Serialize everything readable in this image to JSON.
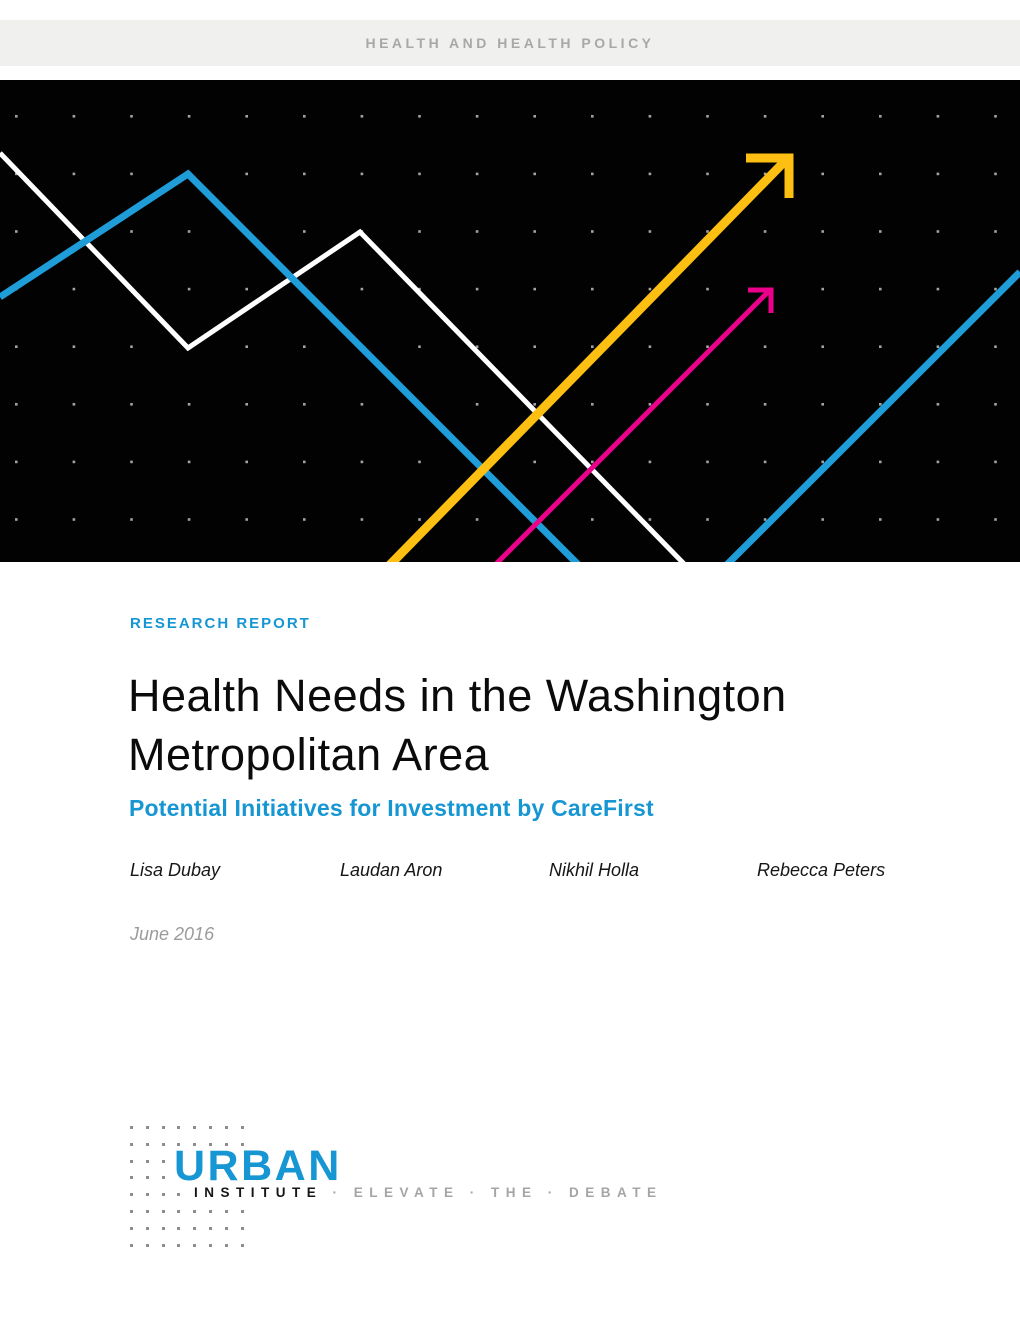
{
  "band": {
    "label": "HEALTH AND HEALTH POLICY"
  },
  "report": {
    "eyebrow": "RESEARCH REPORT",
    "title_line1": "Health Needs in the Washington",
    "title_line2": "Metropolitan Area",
    "subtitle": "Potential Initiatives for Investment by CareFirst",
    "authors": [
      "Lisa Dubay",
      "Laudan Aron",
      "Nikhil Holla",
      "Rebecca Peters"
    ],
    "date": "June 2016"
  },
  "logo": {
    "name": "URBAN",
    "institute": "INSTITUTE",
    "tagline": "· ELEVATE · THE · DEBATE"
  },
  "colors": {
    "accent": "#1696d2",
    "hero_blue": "#1f9dd9",
    "yellow": "#fdbf11",
    "magenta": "#ec008b",
    "line_white": "#ffffff",
    "band_bg": "#f0f0ee",
    "band_text": "#a8a8a8",
    "title_text": "#0b0b0b",
    "date_text": "#9b9b9b",
    "logo_dot": "#8d8d8d",
    "tagline_gray": "#a5a5a5",
    "hero_dot": "#c0c0c0",
    "hero_bg": "#020202"
  }
}
